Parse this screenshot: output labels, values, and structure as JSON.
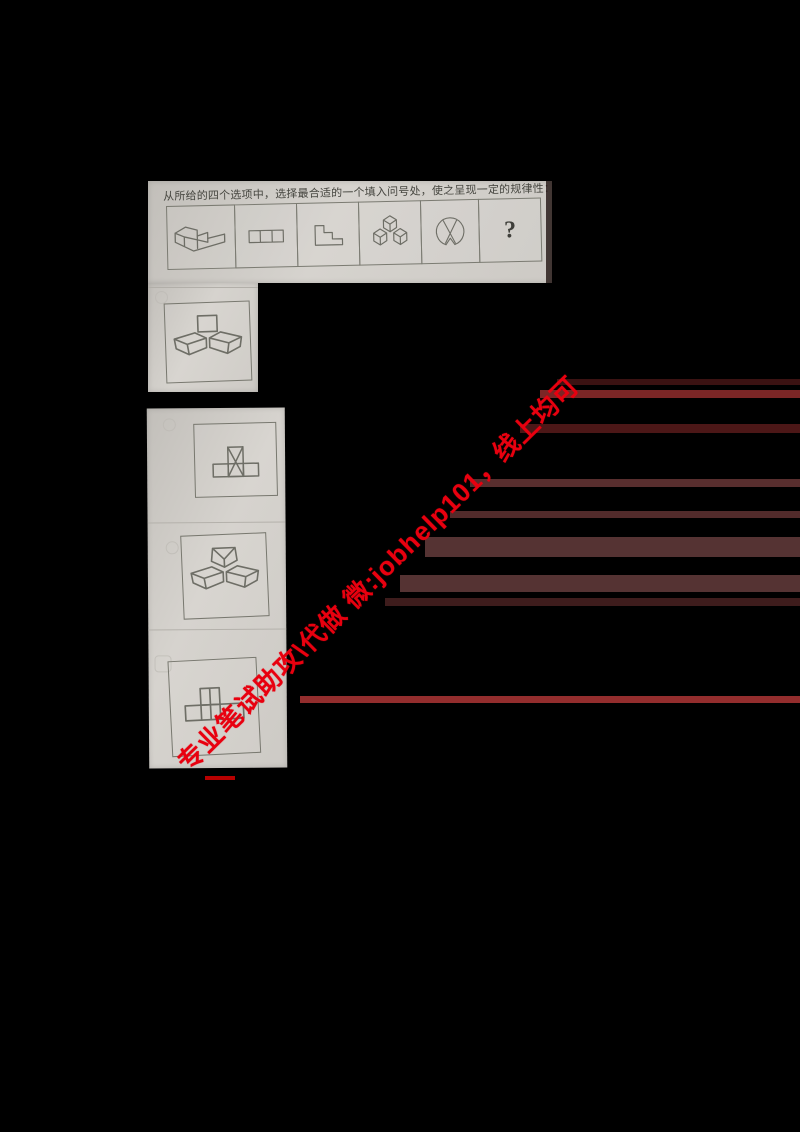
{
  "question": {
    "instruction": "从所给的四个选项中，选择最合适的一个填入问号处，使之呈现一定的规律性：",
    "sequence_cells": [
      {
        "name": "staircase-3d",
        "description": "isometric two-step staircase solid"
      },
      {
        "name": "three-squares-row",
        "description": "flat row of three squares"
      },
      {
        "name": "staircase-2d",
        "description": "flat staircase profile outline"
      },
      {
        "name": "three-cubes-3d",
        "description": "three cubes in trefoil arrangement"
      },
      {
        "name": "circle-with-cross",
        "description": "circle with crossing chords and bottom notch"
      },
      {
        "name": "question-mark",
        "label": "?"
      }
    ]
  },
  "options": [
    {
      "id": "A",
      "figure": "square-above-two-wedges-3d"
    },
    {
      "id": "B",
      "figure": "t-shape-with-x-square-2d"
    },
    {
      "id": "C",
      "figure": "three-wedges-3d"
    },
    {
      "id": "D",
      "figure": "grid-t-shape-2d"
    }
  ],
  "watermark": {
    "text": "专业笔试助攻\\代做 微:jobhelp101，线上均可",
    "color": "#e8000f"
  },
  "colors": {
    "background": "#000000",
    "paper": "#cfccc7",
    "ink": "#6e6e66",
    "artifact_red": "#a33232"
  }
}
